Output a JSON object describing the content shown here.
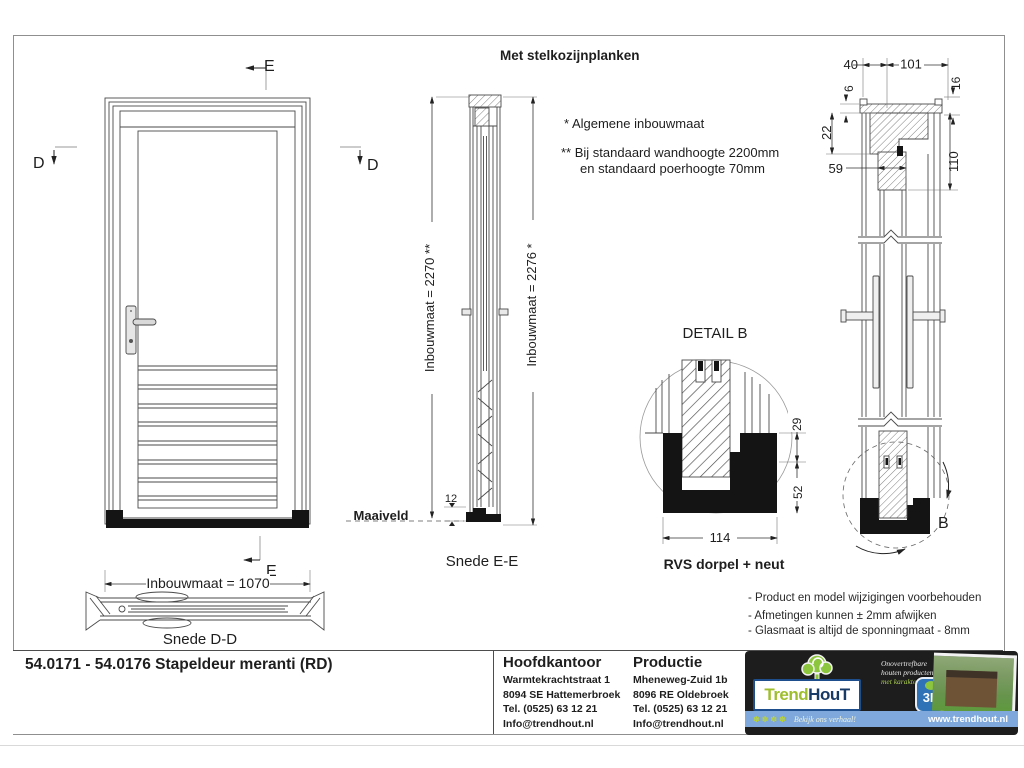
{
  "header": {
    "note": "Met stelkozijnplanken",
    "footnote1": "*  Algemene inbouwmaat",
    "footnote2a": "** Bij standaard wandhoogte 2200mm",
    "footnote2b": "en standaard poerhoogte 70mm"
  },
  "markers": {
    "e": "E",
    "d": "D",
    "b": "B"
  },
  "dims": {
    "front_width": "Inbouwmaat = 1070",
    "ee_left": "Inbouwmaat = 2270 **",
    "ee_right": "Inbouwmaat = 2276 *",
    "shoe_height": "12",
    "top_40": "40",
    "top_101": "101",
    "top_6": "6",
    "top_16": "16",
    "top_22": "22",
    "top_59": "59",
    "top_110": "110",
    "db_29": "29",
    "db_52": "52",
    "db_114": "114"
  },
  "labels": {
    "maaiveld": "Maaiveld"
  },
  "captions": {
    "snede_dd": "Snede D-D",
    "snede_ee": "Snede E-E",
    "detail_b": "DETAIL  B",
    "rvs": "RVS dorpel + neut"
  },
  "notes": [
    "- Product en model wijzigingen voorbehouden",
    "- Afmetingen kunnen ± 2mm afwijken",
    "- Glasmaat is altijd de sponningmaat - 8mm"
  ],
  "title_block": {
    "drawing_title": "54.0171 - 54.0176 Stapeldeur meranti (RD)",
    "office": {
      "heading": "Hoofdkantoor",
      "lines": [
        "Warmtekrachtstraat 1",
        "8094 SE Hattemerbroek",
        "Tel. (0525) 63 12 21",
        "Info@trendhout.nl"
      ]
    },
    "production": {
      "heading": "Productie",
      "lines": [
        "Mheneweg-Zuid 1b",
        "8096 RE Oldebroek",
        "Tel. (0525) 63 12 21",
        "Info@trendhout.nl"
      ]
    },
    "logo": {
      "brand_trend": "Trend",
      "brand_hout": "HouT",
      "tagline1": "Onovertrefbare",
      "tagline2": "houten producten",
      "tagline3": "met karakter",
      "badge_3d": "3D",
      "stars": "✽✽✽✽",
      "strip_text": "Bekijk ons verhaal!",
      "website": "www.trendhout.nl"
    }
  }
}
